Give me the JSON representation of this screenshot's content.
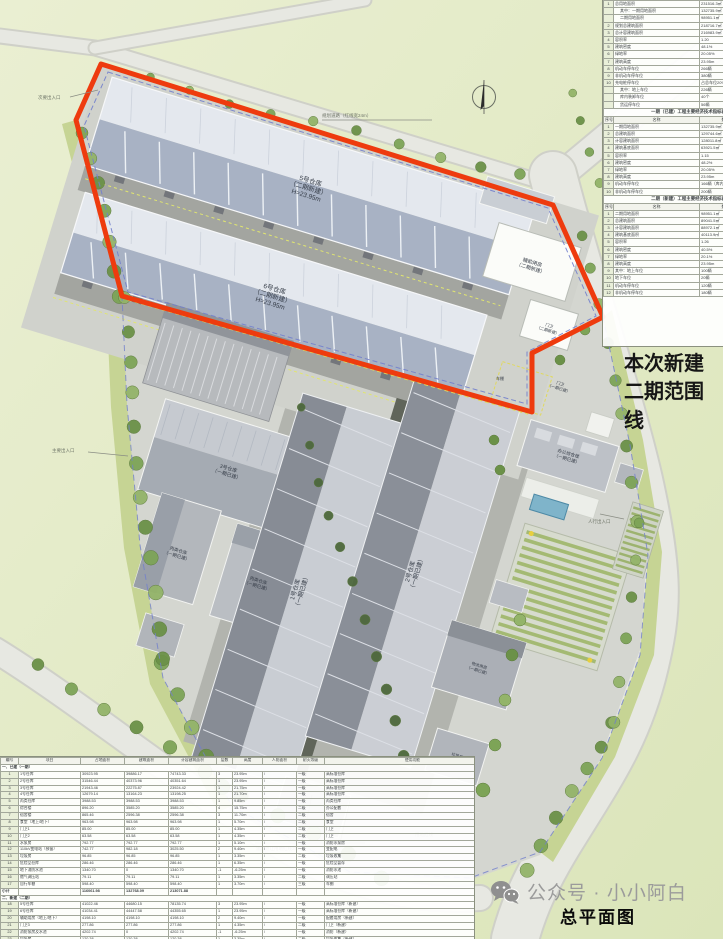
{
  "title": "总平面图",
  "watermark": {
    "icon": "wechat-icon",
    "text": "公众号 · 小小阿白"
  },
  "notes": {
    "phase2_note": "本次新建二期范围线"
  },
  "plan": {
    "colors": {
      "boundary_red": "#ee3b0e",
      "parcel_blue_dash": "#7280cc",
      "setback_yellow_dash": "#e0d95f",
      "roof_blue_gray": "#a8b2c4",
      "roof_light": "#e4e8ee",
      "water_blue": "#7fb4ca",
      "tree_green": "#7da457",
      "background_green": "#e6ecca"
    },
    "compass": "north-arrow",
    "labels": [
      "5号仓库\n（二期新建）\nH=23.95m",
      "6号仓库\n（二期新建）\nH=23.95m",
      "辅助用房\n（二期新建）",
      "门卫\n（二期新建）",
      "3号仓库\n（一期已建）",
      "丙类仓库\n（一期已建）",
      "丙类仓库\n（一期已建）",
      "1号仓库\n（一期已建）",
      "2号仓库\n（一期已建）",
      "办公综合楼\n（一期已建）",
      "物流用房\n（一期已建）",
      "垃圾房\n（一期已建）",
      "门卫\n（一期已建）",
      "车棚"
    ],
    "annotations": [
      "次要出入口",
      "规划道路（红线宽24m）",
      "主要出入口",
      "人行出入口",
      "建筑退让用地红线25m",
      "用地红线"
    ]
  },
  "indicator_table": {
    "summary_rows": [
      {
        "no": "1",
        "label": "总用地面积",
        "value": "231516.3㎡"
      },
      {
        "no": "",
        "label": "其中：一期用地面积",
        "value": "132735.9㎡",
        "indent": true
      },
      {
        "no": "",
        "label": "二期用地面积",
        "value": "98951.1㎡",
        "indent": true
      },
      {
        "no": "2",
        "label": "规划总建筑面积",
        "value": "218716.7㎡"
      },
      {
        "no": "3",
        "label": "总计容建筑面积",
        "value": "216983.9㎡"
      },
      {
        "no": "4",
        "label": "容积率",
        "value": "1.20"
      },
      {
        "no": "5",
        "label": "建筑密度",
        "value": "48.1%"
      },
      {
        "no": "6",
        "label": "绿地率",
        "value": "20.05%"
      },
      {
        "no": "7",
        "label": "建筑高度",
        "value": "23.95m"
      },
      {
        "no": "8",
        "label": "机动车停车位",
        "value": "266辆"
      },
      {
        "no": "9",
        "label": "非机动车停车位",
        "value": "380辆"
      },
      {
        "no": "10",
        "label": "充电桩停车位",
        "value": "占总车位20%"
      },
      {
        "no": "",
        "label": "其中：地上车位",
        "value": "226辆",
        "indent": true
      },
      {
        "no": "",
        "label": "库内装卸车位",
        "value": "40个",
        "indent": true
      },
      {
        "no": "",
        "label": "货运停车位",
        "value": "56辆",
        "indent": true
      }
    ],
    "sections": [
      {
        "header": "一期（已建）工程主要经济技术指标表",
        "col_headers": [
          "序号",
          "名称",
          "数值",
          ""
        ],
        "rows": [
          [
            "1",
            "一期用地面积",
            "132735.9㎡"
          ],
          [
            "2",
            "总建筑面积",
            "129744.6㎡"
          ],
          [
            "3",
            "计容建筑面积",
            "128011.8㎡"
          ],
          [
            "4",
            "建筑基底面积",
            "63921.5㎡"
          ],
          [
            "5",
            "容积率",
            "1.15"
          ],
          [
            "6",
            "建筑密度",
            "48.2%"
          ],
          [
            "7",
            "绿地率",
            "20.05%"
          ],
          [
            "8",
            "建筑高度",
            "23.95m"
          ],
          [
            "9",
            "机动车停车位",
            "166辆（库内及地面）"
          ],
          [
            "10",
            "非机动车停车位",
            "200辆"
          ]
        ]
      },
      {
        "header": "二期（新建）工程主要经济技术指标表",
        "col_headers": [
          "序号",
          "名称",
          "数值",
          ""
        ],
        "rows": [
          [
            "1",
            "二期用地面积",
            "98951.1㎡"
          ],
          [
            "2",
            "总建筑面积",
            "89041.5㎡"
          ],
          [
            "3",
            "计容建筑面积",
            "88972.1㎡"
          ],
          [
            "4",
            "建筑基底面积",
            "40113.9㎡"
          ],
          [
            "5",
            "容积率",
            "1.26"
          ],
          [
            "6",
            "建筑密度",
            "40.5%"
          ],
          [
            "7",
            "绿地率",
            "20.1%"
          ],
          [
            "8",
            "建筑高度",
            "23.95m"
          ],
          [
            "9",
            "其中：地上车位",
            "100辆"
          ],
          [
            "10",
            "地下车位",
            "20辆"
          ],
          [
            "11",
            "机动车停车位",
            "120辆"
          ],
          [
            "12",
            "非机动车停车位",
            "180辆"
          ]
        ]
      }
    ]
  },
  "building_table": {
    "col_headers": [
      "编号",
      "项目",
      "占地面积",
      "建筑面积",
      "计容建筑面积",
      "层数",
      "高度",
      "人防面积",
      "耐火等级",
      "使用功能"
    ],
    "rows": [
      {
        "section": "一、已建（一期）"
      },
      [
        "1",
        "1号仓库",
        "30923.95",
        "39886.17",
        "74743.33",
        "3",
        "23.95m",
        "/",
        "一级",
        "高标准仓库"
      ],
      [
        "2",
        "2号仓库",
        "31546.44",
        "40373.96",
        "40351.64",
        "1",
        "23.95m",
        "/",
        "一级",
        "高标准仓库"
      ],
      [
        "3",
        "3号仓库",
        "21943.46",
        "22275.87",
        "23924.42",
        "1",
        "21.75m",
        "/",
        "一级",
        "高标准仓库"
      ],
      [
        "4",
        "4号仓库",
        "12679.14",
        "13164.23",
        "13198.25",
        "1",
        "21.70m",
        "/",
        "一级",
        "高标准仓库"
      ],
      [
        "5",
        "丙类仓库",
        "3988.53",
        "3988.53",
        "3988.53",
        "1",
        "9.85m",
        "/",
        "一级",
        "丙类仓库"
      ],
      [
        "6",
        "综合楼",
        "896.20",
        "3585.20",
        "3585.20",
        "4",
        "15.75m",
        "/",
        "二级",
        "办公配套"
      ],
      [
        "7",
        "宿舍楼",
        "865.46",
        "2596.38",
        "2596.38",
        "3",
        "11.70m",
        "/",
        "二级",
        "宿舍"
      ],
      [
        "8",
        "食堂（地上/地下）",
        "963.98",
        "963.98",
        "963.98",
        "1",
        "5.70m",
        "/",
        "二级",
        "食堂"
      ],
      [
        "9",
        "门卫1",
        "85.00",
        "85.00",
        "85.00",
        "1",
        "4.35m",
        "/",
        "二级",
        "门卫"
      ],
      [
        "10",
        "门卫2",
        "63.58",
        "63.58",
        "63.58",
        "1",
        "4.35m",
        "/",
        "二级",
        "门卫"
      ],
      [
        "11",
        "水泵房",
        "792.77",
        "792.77",
        "792.77",
        "1",
        "5.10m",
        "/",
        "一级",
        "消防水泵房"
      ],
      [
        "12",
        "110kV变电站（预留）",
        "742.77",
        "982.18",
        "3025.50",
        "2",
        "9.40m",
        "/",
        "一级",
        "变配电"
      ],
      [
        "13",
        "垃圾房",
        "96.85",
        "96.85",
        "96.85",
        "1",
        "3.35m",
        "/",
        "二级",
        "垃圾收集"
      ],
      [
        "14",
        "危险品仓库",
        "286.46",
        "286.46",
        "286.46",
        "1",
        "6.35m",
        "/",
        "一级",
        "危险品暂存"
      ],
      [
        "15",
        "地下消防水池",
        "1340.70",
        "0",
        "1340.70",
        "-1",
        "-6.25m",
        "/",
        "一级",
        "消防水池"
      ],
      [
        "16",
        "燃气调压站",
        "79.11",
        "79.11",
        "79.11",
        "1",
        "3.35m",
        "/",
        "二级",
        "调压站"
      ],
      [
        "17",
        "自行车棚",
        "598.40",
        "598.40",
        "598.40",
        "1",
        "3.70m",
        "/",
        "三级",
        "车棚"
      ],
      {
        "subtotal": [
          "小计",
          "",
          "116061.98",
          "132768.09",
          "213071.88",
          "",
          "",
          "",
          "",
          ""
        ]
      },
      {
        "section": "二、新建（二期）"
      },
      [
        "18",
        "5号仓库",
        "41022.46",
        "44680.15",
        "78135.74",
        "3",
        "23.95m",
        "/",
        "一级",
        "高标准仓库（新建）"
      ],
      [
        "19",
        "6号仓库",
        "41034.41",
        "44447.58",
        "44355.65",
        "1",
        "23.95m",
        "/",
        "一级",
        "高标准仓库（新建）"
      ],
      [
        "20",
        "辅助用房（地上/地下）",
        "4198.10",
        "4198.10",
        "4198.10",
        "2",
        "9.40m",
        "/",
        "一级",
        "配套用房（新建）"
      ],
      [
        "21",
        "门卫3",
        "277.86",
        "277.86",
        "277.86",
        "1",
        "4.35m",
        "/",
        "二级",
        "门卫（新建）"
      ],
      [
        "22",
        "消防泵房及水池",
        "4202.74",
        "0",
        "4202.74",
        "-1",
        "-6.25m",
        "/",
        "一级",
        "消防（新建）"
      ],
      [
        "23",
        "垃圾房",
        "120.38",
        "120.38",
        "120.38",
        "1",
        "3.35m",
        "/",
        "二级",
        "垃圾收集（新建）"
      ],
      {
        "subtotal": [
          "小计",
          "",
          "89025.84",
          "89402.12",
          "162708.88",
          "",
          "",
          "",
          "",
          ""
        ]
      },
      {
        "subtotal": [
          "合计",
          "",
          "205087.82",
          "222170.21",
          "375780.76",
          "",
          "",
          "",
          "",
          ""
        ]
      }
    ]
  }
}
